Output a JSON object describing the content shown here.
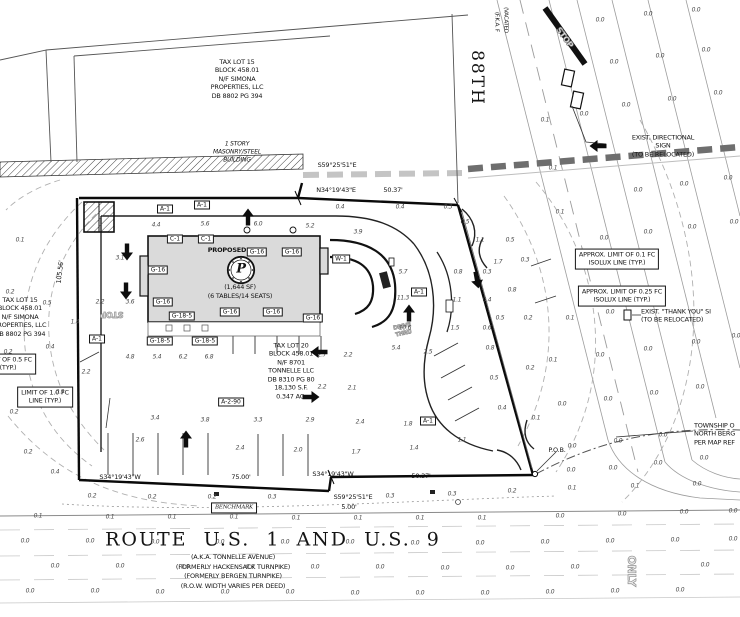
{
  "plan": {
    "parcel_15_top": "TAX LOT 15\nBLOCK 458.01\nN/F SIMONA\nPROPERTIES, LLC\nDB 8802 PG 394",
    "parcel_15_left": "TAX LOT 15\nBLOCK 458.01\nN/F SIMONA\nPROPERTIES, LLC\nDB 8802 PG 394",
    "parcel_20": "TAX LOT 20\nBLOCK 458.01\nN/F 8701\nTONNELLE LLC\nDB 8310 PG 80\n18,130 S.F.\n0.347 AC.",
    "existing_building_note": "1 STORY\nMASONRY/STEEL\nBUILDING",
    "building": {
      "proposed_label": "PROPOSED",
      "logo_letter": "P",
      "area": "(1,644  SF)",
      "seating": "(6 TABLES/14 SEATS)"
    },
    "street_88th": {
      "name": "88TH",
      "fka": "(F.K.A. F",
      "vacated": "(VACATED"
    },
    "route": {
      "title": "ROUTE U.S. 1 AND U.S. 9",
      "aka": "(A.K.A. TONNELLE AVENUE)",
      "formerly_1": "(FORMERLY HACKENSACK TURNPIKE)",
      "formerly_2": "(FORMERLY BERGEN TURNPIKE)",
      "row_note": "(R.O.W. WIDTH VARIES PER DEED)"
    },
    "notes": {
      "directional_sign": "EXIST. DIRECTIONAL SIGN\n(TO BE RELOCATED)",
      "thank_you_sign": "EXIST. \"THANK YOU\" SI\n(TO BE RELOCATED)",
      "township": "TOWNSHIP O\nNORTH BERG\nPER MAP REF",
      "isolux_01": "APPROX. LIMIT OF 0.1 FC\nISOLUX LINE (TYP.)",
      "isolux_025": "APPROX. LIMIT OF 0.25 FC\nISOLUX LINE (TYP.)",
      "fc_05": "LIMIT OF 0.5 FC\n(TYP.)",
      "fc_10": "LIMIT OF 1.0 FC\nLINE (TYP.)",
      "benchmark": "BENCHMARK",
      "pob": "P.O.B."
    },
    "markings": {
      "stop_sw": "STOP",
      "stop_ne": "STOP",
      "drive_thru": "DRIVE\nTHRU",
      "only": "ONLY"
    }
  },
  "dimensions": [
    {
      "t": "S59°25'51\"E",
      "x": 337,
      "y": 165
    },
    {
      "t": "N34°19'43\"E",
      "x": 336,
      "y": 190
    },
    {
      "t": "50.37'",
      "x": 393,
      "y": 190
    },
    {
      "t": "S34°19'43\"W",
      "x": 120,
      "y": 477
    },
    {
      "t": "75.00'",
      "x": 241,
      "y": 477
    },
    {
      "t": "S34°19'43\"W",
      "x": 333,
      "y": 474
    },
    {
      "t": "50.37'",
      "x": 421,
      "y": 476
    },
    {
      "t": "S59°25'51\"E",
      "x": 353,
      "y": 497
    },
    {
      "t": "5.00'",
      "x": 349,
      "y": 507
    },
    {
      "t": "105.56'",
      "x": 60,
      "y": 272,
      "r": -83
    }
  ],
  "keynotes": [
    {
      "t": "A-1",
      "x": 165,
      "y": 209
    },
    {
      "t": "A-1",
      "x": 202,
      "y": 205
    },
    {
      "t": "A-1",
      "x": 97,
      "y": 339
    },
    {
      "t": "A-1",
      "x": 419,
      "y": 292
    },
    {
      "t": "A-1",
      "x": 428,
      "y": 421
    },
    {
      "t": "C-1",
      "x": 175,
      "y": 239
    },
    {
      "t": "C-1",
      "x": 206,
      "y": 239
    },
    {
      "t": "G-16",
      "x": 257,
      "y": 252
    },
    {
      "t": "G-16",
      "x": 292,
      "y": 252
    },
    {
      "t": "G-16",
      "x": 158,
      "y": 270
    },
    {
      "t": "G-16",
      "x": 163,
      "y": 302
    },
    {
      "t": "G-16",
      "x": 230,
      "y": 312
    },
    {
      "t": "G-16",
      "x": 273,
      "y": 312
    },
    {
      "t": "G-16",
      "x": 313,
      "y": 318
    },
    {
      "t": "G-18-5",
      "x": 182,
      "y": 316
    },
    {
      "t": "G-18-5",
      "x": 160,
      "y": 341
    },
    {
      "t": "G-18-5",
      "x": 205,
      "y": 341
    },
    {
      "t": "W-1",
      "x": 341,
      "y": 259
    },
    {
      "t": "A-2-90",
      "x": 231,
      "y": 402
    }
  ],
  "arrows": [
    [
      127,
      252,
      180
    ],
    [
      126,
      291,
      180
    ],
    [
      248,
      217,
      0
    ],
    [
      186,
      439,
      0
    ],
    [
      409,
      313,
      0
    ],
    [
      477,
      280,
      170
    ],
    [
      319,
      352,
      270
    ],
    [
      311,
      397,
      90
    ],
    [
      598,
      146,
      270
    ]
  ],
  "photometrics": [
    [
      38,
      516,
      "0.1"
    ],
    [
      110,
      517,
      "0.1"
    ],
    [
      172,
      517,
      "0.1"
    ],
    [
      234,
      517,
      "0.1"
    ],
    [
      296,
      518,
      "0.1"
    ],
    [
      358,
      518,
      "0.1"
    ],
    [
      420,
      518,
      "0.1"
    ],
    [
      482,
      518,
      "0.1"
    ],
    [
      560,
      516,
      "0.0"
    ],
    [
      622,
      514,
      "0.0"
    ],
    [
      684,
      512,
      "0.0"
    ],
    [
      733,
      511,
      "0.0"
    ],
    [
      25,
      541,
      "0.0"
    ],
    [
      90,
      541,
      "0.0"
    ],
    [
      155,
      542,
      "0.0"
    ],
    [
      220,
      542,
      "0.0"
    ],
    [
      285,
      542,
      "0.0"
    ],
    [
      350,
      542,
      "0.0"
    ],
    [
      415,
      543,
      "0.0"
    ],
    [
      480,
      543,
      "0.0"
    ],
    [
      545,
      542,
      "0.0"
    ],
    [
      610,
      541,
      "0.0"
    ],
    [
      675,
      540,
      "0.0"
    ],
    [
      733,
      539,
      "0.0"
    ],
    [
      55,
      566,
      "0.0"
    ],
    [
      120,
      566,
      "0.0"
    ],
    [
      185,
      567,
      "0.0"
    ],
    [
      250,
      567,
      "0.0"
    ],
    [
      315,
      567,
      "0.0"
    ],
    [
      380,
      567,
      "0.0"
    ],
    [
      445,
      568,
      "0.0"
    ],
    [
      510,
      568,
      "0.0"
    ],
    [
      575,
      567,
      "0.0"
    ],
    [
      705,
      565,
      "0.0"
    ],
    [
      30,
      591,
      "0.0"
    ],
    [
      95,
      591,
      "0.0"
    ],
    [
      160,
      592,
      "0.0"
    ],
    [
      225,
      592,
      "0.0"
    ],
    [
      290,
      592,
      "0.0"
    ],
    [
      355,
      593,
      "0.0"
    ],
    [
      420,
      593,
      "0.0"
    ],
    [
      485,
      593,
      "0.0"
    ],
    [
      550,
      592,
      "0.0"
    ],
    [
      615,
      591,
      "0.0"
    ],
    [
      680,
      590,
      "0.0"
    ],
    [
      92,
      496,
      "0.2"
    ],
    [
      152,
      497,
      "0.2"
    ],
    [
      212,
      497,
      "0.2"
    ],
    [
      272,
      497,
      "0.3"
    ],
    [
      390,
      496,
      "0.3"
    ],
    [
      452,
      494,
      "0.3"
    ],
    [
      512,
      491,
      "0.2"
    ],
    [
      572,
      488,
      "0.1"
    ],
    [
      635,
      486,
      "0.1"
    ],
    [
      697,
      484,
      "0.0"
    ],
    [
      600,
      20,
      "0.0"
    ],
    [
      648,
      14,
      "0.0"
    ],
    [
      696,
      10,
      "0.0"
    ],
    [
      614,
      62,
      "0.0"
    ],
    [
      660,
      56,
      "0.0"
    ],
    [
      706,
      50,
      "0.0"
    ],
    [
      626,
      105,
      "0.0"
    ],
    [
      672,
      99,
      "0.0"
    ],
    [
      718,
      93,
      "0.0"
    ],
    [
      545,
      120,
      "0.1"
    ],
    [
      584,
      114,
      "0.0"
    ],
    [
      553,
      168,
      "0.1"
    ],
    [
      638,
      190,
      "0.0"
    ],
    [
      684,
      184,
      "0.0"
    ],
    [
      728,
      178,
      "0.0"
    ],
    [
      560,
      212,
      "0.1"
    ],
    [
      604,
      238,
      "0.0"
    ],
    [
      648,
      232,
      "0.0"
    ],
    [
      692,
      227,
      "0.0"
    ],
    [
      734,
      222,
      "0.0"
    ],
    [
      570,
      318,
      "0.1"
    ],
    [
      610,
      312,
      "0.0"
    ],
    [
      553,
      360,
      "0.1"
    ],
    [
      600,
      355,
      "0.0"
    ],
    [
      648,
      349,
      "0.0"
    ],
    [
      696,
      342,
      "0.0"
    ],
    [
      736,
      336,
      "0.0"
    ],
    [
      562,
      404,
      "0.0"
    ],
    [
      608,
      399,
      "0.0"
    ],
    [
      654,
      393,
      "0.0"
    ],
    [
      700,
      387,
      "0.0"
    ],
    [
      572,
      446,
      "0.0"
    ],
    [
      618,
      441,
      "0.0"
    ],
    [
      663,
      435,
      "0.0"
    ],
    [
      571,
      470,
      "0.0"
    ],
    [
      613,
      468,
      "0.0"
    ],
    [
      658,
      463,
      "0.0"
    ],
    [
      704,
      458,
      "0.0"
    ],
    [
      498,
      262,
      "1.7"
    ],
    [
      512,
      290,
      "0.8"
    ],
    [
      500,
      318,
      "0.5"
    ],
    [
      490,
      348,
      "0.8"
    ],
    [
      494,
      378,
      "0.5"
    ],
    [
      502,
      408,
      "0.4"
    ],
    [
      458,
      272,
      "0.8"
    ],
    [
      457,
      300,
      "1.1"
    ],
    [
      455,
      328,
      "1.5"
    ],
    [
      487,
      272,
      "0.3"
    ],
    [
      487,
      300,
      "0.4"
    ],
    [
      487,
      328,
      "0.6"
    ],
    [
      480,
      240,
      "1.1"
    ],
    [
      510,
      240,
      "0.5"
    ],
    [
      525,
      260,
      "0.3"
    ],
    [
      528,
      318,
      "0.2"
    ],
    [
      530,
      368,
      "0.2"
    ],
    [
      536,
      418,
      "0.1"
    ],
    [
      403,
      272,
      "5.7"
    ],
    [
      403,
      298,
      "11.3"
    ],
    [
      405,
      328,
      "10.6"
    ],
    [
      396,
      348,
      "5.4"
    ],
    [
      428,
      352,
      "2.5"
    ],
    [
      130,
      302,
      "3.6"
    ],
    [
      100,
      302,
      "2.2"
    ],
    [
      130,
      357,
      "4.8"
    ],
    [
      157,
      357,
      "5.4"
    ],
    [
      183,
      357,
      "6.2"
    ],
    [
      209,
      357,
      "6.8"
    ],
    [
      322,
      355,
      "2.7"
    ],
    [
      348,
      355,
      "2.2"
    ],
    [
      322,
      387,
      "2.2"
    ],
    [
      352,
      388,
      "2.1"
    ],
    [
      156,
      225,
      "4.4"
    ],
    [
      205,
      224,
      "5.6"
    ],
    [
      258,
      224,
      "6.0"
    ],
    [
      310,
      226,
      "5.2"
    ],
    [
      358,
      232,
      "3.9"
    ],
    [
      120,
      258,
      "3.1"
    ],
    [
      155,
      418,
      "3.4"
    ],
    [
      205,
      420,
      "3.8"
    ],
    [
      258,
      420,
      "3.3"
    ],
    [
      310,
      420,
      "2.9"
    ],
    [
      360,
      422,
      "2.4"
    ],
    [
      408,
      424,
      "1.8"
    ],
    [
      140,
      440,
      "2.6"
    ],
    [
      240,
      448,
      "2.4"
    ],
    [
      298,
      450,
      "2.0"
    ],
    [
      356,
      452,
      "1.7"
    ],
    [
      414,
      448,
      "1.4"
    ],
    [
      462,
      440,
      "1.1"
    ],
    [
      47,
      303,
      "0.5"
    ],
    [
      75,
      322,
      "1.4"
    ],
    [
      50,
      347,
      "0.4"
    ],
    [
      86,
      372,
      "2.2"
    ],
    [
      60,
      392,
      "0.9"
    ],
    [
      20,
      240,
      "0.1"
    ],
    [
      10,
      292,
      "0.2"
    ],
    [
      8,
      352,
      "0.2"
    ],
    [
      14,
      412,
      "0.2"
    ],
    [
      28,
      452,
      "0.2"
    ],
    [
      55,
      472,
      "0.4"
    ],
    [
      340,
      207,
      "0.4"
    ],
    [
      400,
      207,
      "0.4"
    ],
    [
      448,
      207,
      "0.3"
    ],
    [
      465,
      222,
      "0.5"
    ]
  ]
}
